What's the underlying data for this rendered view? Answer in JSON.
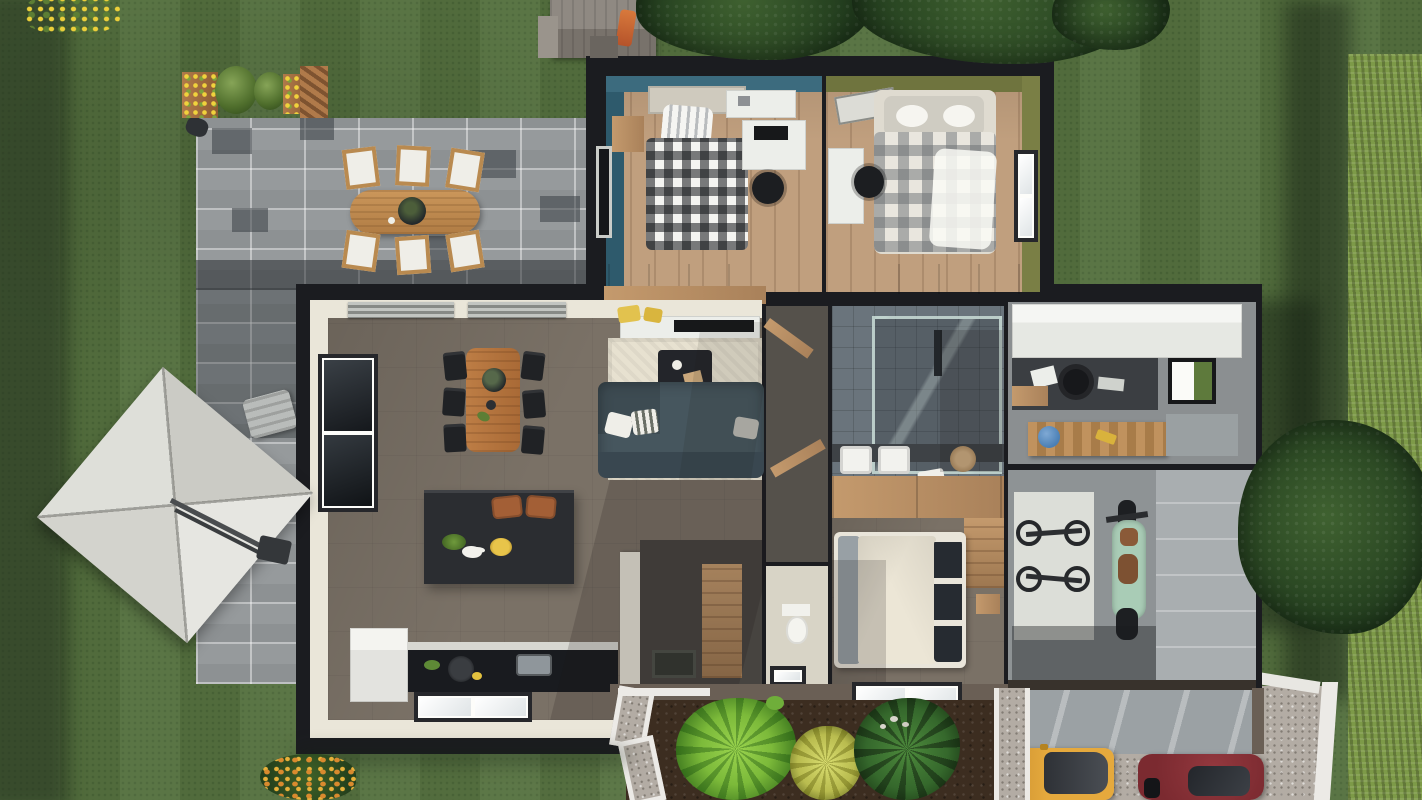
{
  "scene": {
    "type": "3d-floor-plan-top-view",
    "name": "Aerial 3D rendering of a single-storey house with garden, patio and driveway",
    "time_of_day": "daylight"
  },
  "palette": {
    "lawn": "#55713f",
    "lawn_shadow": "#2c4226",
    "hedge": "#7d9a48",
    "paver": "#969a9c",
    "paver_dark": "#3c4347",
    "roof": "#1b1c20",
    "wall_cream": "#eae6d9",
    "wall_brown": "#6a5f55",
    "floor_taupe": "#7a7166",
    "floor_wood": "#c09f7e",
    "wall_teal": "#3c6b7e",
    "wall_teal_dark": "#2e5a6c",
    "wall_olive": "#6f743e",
    "wall_olive_light": "#7a7f45",
    "sofa": "#46565e",
    "sofa_back": "#394750",
    "rug": "#e7e1d0",
    "table_wood": "#b4743f",
    "island": "#2b2d31",
    "counter": "#191b1f",
    "stool": "#a35f36",
    "tile_gray": "#6a747c",
    "vanity_wood": "#c09a72",
    "duvet": "#ece6d6",
    "pillow_dark": "#262b31",
    "garage_floor": "#8e9395",
    "garage_light": "#a9aeb0",
    "moto_mint": "#a9ccb6",
    "gravel": "#b3aca4",
    "apron": "#9ba1a4",
    "car_yellow": "#e5a93d",
    "car_red": "#7b2a30",
    "path_white": "#eceae6",
    "mulch": "#3c2d20",
    "plant_bright": "#7cba3a",
    "plant_dark": "#35682c",
    "plant_yellow": "#b9bc4f",
    "parasol": "#dfdfda",
    "outdoor_wood": "#c08c52",
    "cushion": "#efeee8",
    "white_unit": "#eceeea",
    "desk_dark": "#3b3e42",
    "mat_white": "#dcded8",
    "helmet_blue": "#4a7fb5"
  },
  "house": {
    "rooms": {
      "bedroom_teal": {
        "name": "Bedroom 1 (teal walls)",
        "wall_color": "teal",
        "furniture": [
          "single bed with black & white checked duvet",
          "striped pillow",
          "white desk with monitor",
          "black office chair",
          "white wall shelf",
          "wood nightstand",
          "wood sideboard",
          "dark window on left wall"
        ]
      },
      "bedroom_olive": {
        "name": "Bedroom 2 (olive walls)",
        "wall_color": "olive green",
        "furniture": [
          "double bed with grey plaid duvet",
          "white pillows",
          "white desk",
          "black office chair",
          "window on right wall",
          "skylight panel",
          "wood sideboard"
        ]
      },
      "living_kitchen": {
        "name": "Open-plan living room / kitchen",
        "furniture": [
          "wood dining table with six black chairs",
          "dark L-shaped sofa with three cushions",
          "dark coffee table on cream rug",
          "white TV sideboard with flat TV",
          "two yellow poufs",
          "dark kitchen island with two leather bar stools",
          "black worktop with sink and pans",
          "white fridge cabinet",
          "tall black window on left wall",
          "venetian blinds on top windows",
          "white cat on the floor",
          "front-door mat"
        ]
      },
      "hallway": {
        "name": "Hallway",
        "furniture": [
          "open wood doors",
          "tall wood storage cabinet"
        ]
      },
      "wc": {
        "name": "WC",
        "furniture": [
          "white toilet",
          "small window"
        ]
      },
      "bathroom": {
        "name": "Bathroom",
        "furniture": [
          "walk-in glass shower with grey tiles",
          "double vanity with two white basins",
          "wood drawer unit",
          "round rattan basket",
          "white towel"
        ]
      },
      "master_bedroom": {
        "name": "Master bedroom",
        "furniture": [
          "double bed with cream duvet and dark pillows",
          "grey throw",
          "wood wardrobe",
          "window to front garden"
        ]
      },
      "utility_office": {
        "name": "Utility / home office",
        "furniture": [
          "row of white cabinets",
          "dark desk nook with laptop",
          "black swivel chair",
          "wall frame with moss panel",
          "wood workbench",
          "blue helmet",
          "grey cabinets"
        ]
      },
      "garage": {
        "name": "Garage",
        "contents": [
          "two bicycles on white mat",
          "mint-green motorcycle",
          "sectional door bay"
        ]
      }
    }
  },
  "garden": {
    "lawn": {
      "name": "Lawn",
      "coverage": "wraps the whole plot"
    },
    "hedge": {
      "name": "Clipped hedge along right boundary"
    },
    "patio": {
      "name": "Grey paver patio",
      "furniture": [
        "oval teak dining table",
        "six teak chairs with white cushions",
        "dark serving bowl",
        "sun lounger",
        "white cantilever parasol with dark base",
        "small parasol stand"
      ]
    },
    "planter_row": {
      "name": "Raised planters with yellow flowers and two topiary balls"
    },
    "shed": {
      "name": "Garden shed with orange slide",
      "position": "top edge"
    },
    "trees": {
      "count": 4,
      "positions": [
        "top middle",
        "top right",
        "top right corner",
        "bottom right over hedge"
      ]
    },
    "front_garden": {
      "name": "Front garden bed",
      "plants": [
        "bright green palm",
        "yellow-green grass plant",
        "dark green palm",
        "small sprout",
        "white pebbles"
      ],
      "paths": [
        "white-edged gravel path (zig-zag)",
        "white-edged gravel path (straight)"
      ]
    },
    "corner_flowers": {
      "name": "Yellow flower patch, top-left corner"
    },
    "orange_bush": {
      "name": "Orange flowering bush, bottom edge"
    }
  },
  "driveway": {
    "name": "Gravel driveway",
    "surface": "light gravel",
    "garage_apron": "striped concrete ramp",
    "curb": "white curb strip",
    "vehicles": [
      {
        "type": "car",
        "color_name": "yellow",
        "position": "parked facing garage"
      },
      {
        "type": "car",
        "color_name": "dark red",
        "position": "parked at bottom edge"
      }
    ]
  }
}
